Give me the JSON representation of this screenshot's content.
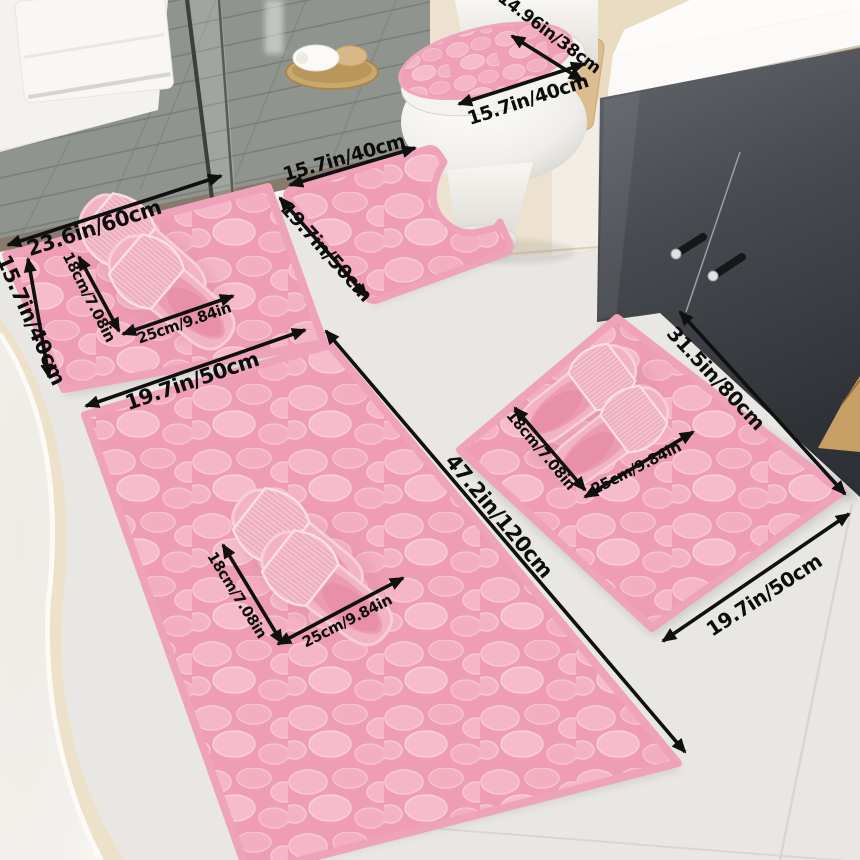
{
  "product": {
    "name": "Pink pebble-textured memory foam bathroom mat 5-piece set",
    "scene_items": [
      "bathtub",
      "shower-tiled-floor",
      "glass-partition",
      "hanging-towel",
      "towel-tray",
      "rolled-towels",
      "toilet-with-pebble-lid-cover",
      "contour-u-mat",
      "small-mat",
      "runner-mat",
      "large-mat",
      "pink-slippers",
      "vanity-cabinet",
      "sink-counter",
      "gold-faucet",
      "mirror"
    ]
  },
  "dimension_labels": {
    "toilet_lid_width": "14.96in/38cm",
    "toilet_lid_length": "15.7in/40cm",
    "contour_mat_width": "15.7in/40cm",
    "contour_mat_length": "19.7in/50cm",
    "small_mat_width": "23.6in/60cm",
    "small_mat_height": "15.7in/40cm",
    "runner_mat_width": "19.7in/50cm",
    "runner_mat_length": "47.2in/120cm",
    "large_mat_length": "31.5in/80cm",
    "large_mat_width": "19.7in/50cm",
    "slipper_width": "18cm/7.08in",
    "slipper_length": "25cm/9.84in"
  },
  "colors": {
    "mat_pink": "#ee9db5",
    "pebble_light": "#f6bccb",
    "mat_border": "#efa3ba",
    "cabinet_dark": "#45484d",
    "counter_white": "#fbfaf8",
    "gold_accent": "#c8a158",
    "shower_tile": "#90948e",
    "floor": "#e9e7e3",
    "arrow_black": "#101010"
  }
}
